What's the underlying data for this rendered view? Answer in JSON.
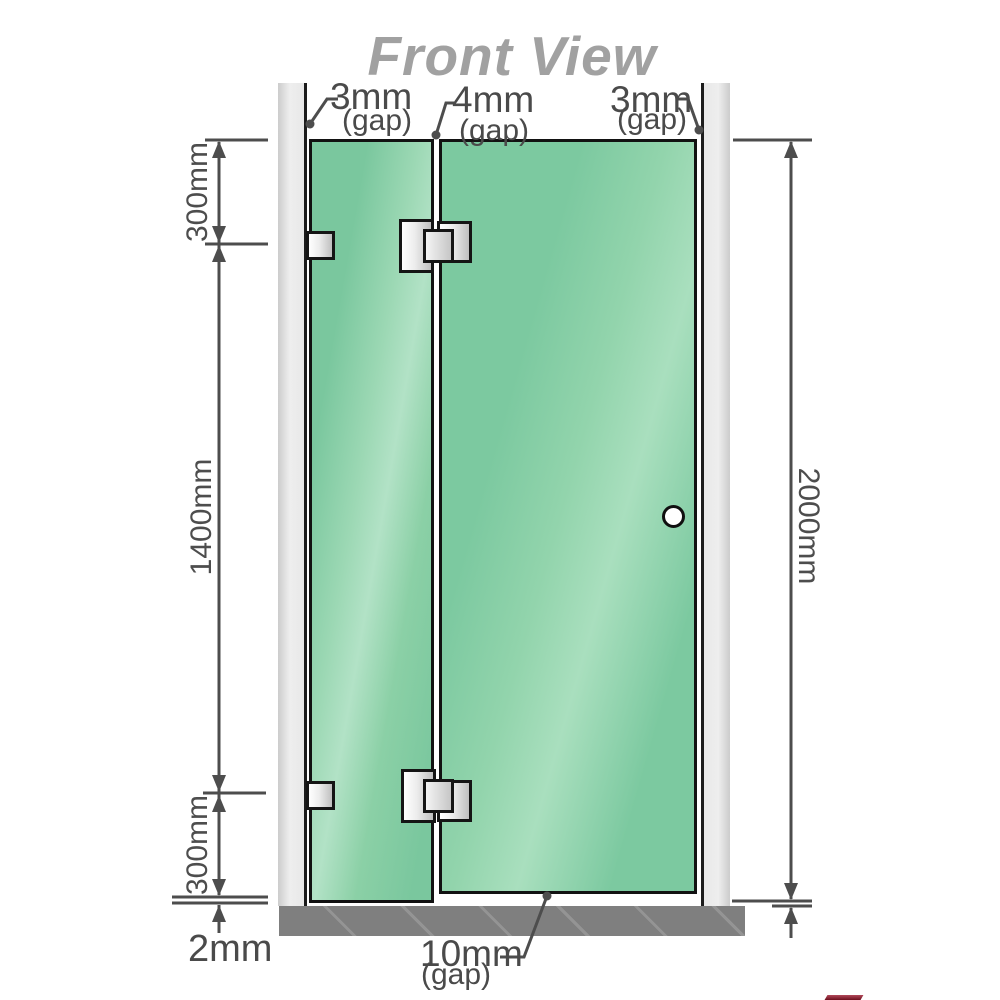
{
  "title": "Front View",
  "colors": {
    "glass": "#7cc9a0",
    "glass_highlight": "#b2e2c6",
    "wall": "#e8e8e8",
    "base": "#7f7f7f",
    "outline": "#121212",
    "dimension_line": "#4d4d4d",
    "metal_light": "#ffffff",
    "metal_dark": "#bfbfbf",
    "title_gray": "#a1a1a1"
  },
  "annotations": {
    "gap_top_left": {
      "value": "3mm",
      "label": "(gap)"
    },
    "gap_top_center": {
      "value": "4mm",
      "label": "(gap)"
    },
    "gap_top_right": {
      "value": "3mm",
      "label": "(gap)"
    },
    "gap_bottom_center": {
      "value": "10mm",
      "label": "(gap)"
    },
    "dim_left_top": "300mm",
    "dim_left_middle": "1400mm",
    "dim_left_bottom": "300mm",
    "dim_right_height": "2000mm",
    "dim_floor_clearance": "2mm"
  }
}
